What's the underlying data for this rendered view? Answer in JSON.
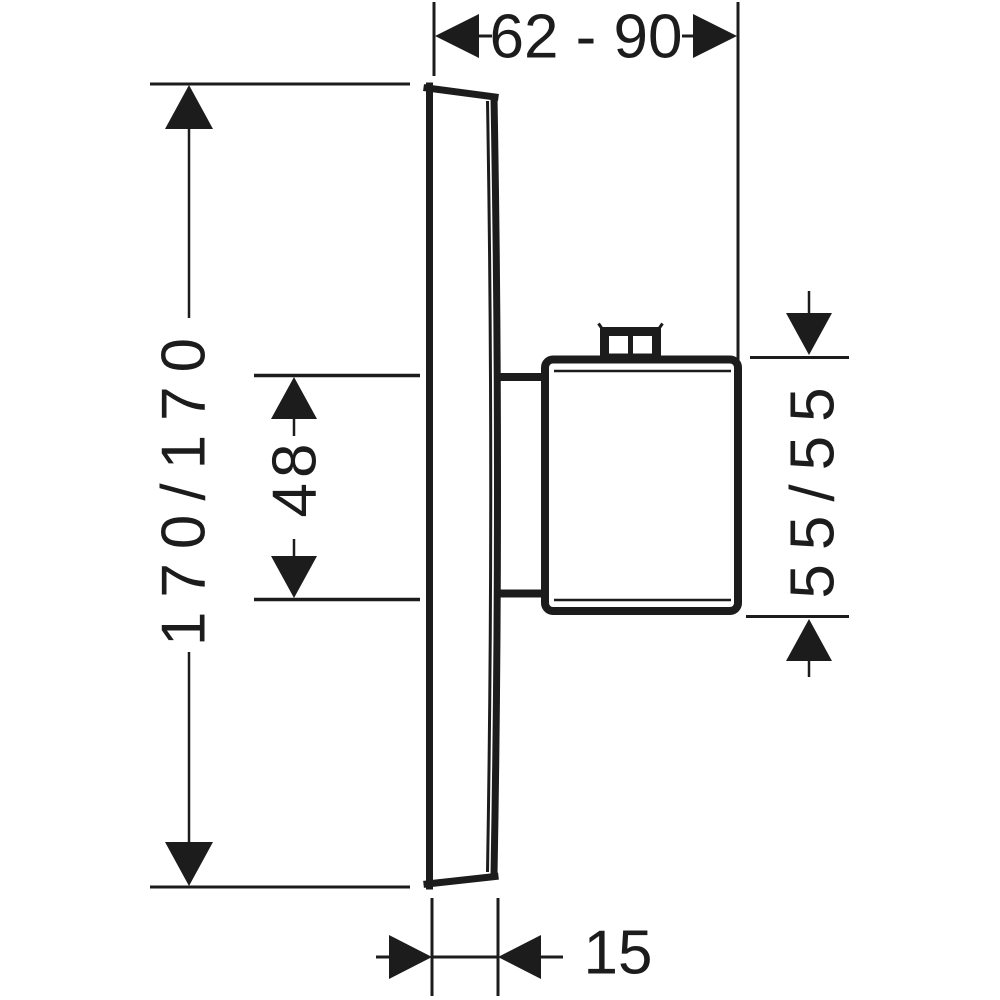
{
  "drawing": {
    "description": "Side-view dimensional drawing of a concealed thermostat mixer (wall plate with handle)"
  },
  "colors": {
    "ink": "#1c1c1c",
    "background": "#ffffff"
  },
  "dimensions": {
    "width_range": {
      "label": "62 - 90",
      "min": 62,
      "max": 90
    },
    "plate_height": {
      "label": "170/170",
      "values": [
        170,
        170
      ]
    },
    "stem_height": {
      "label": "48",
      "values": [
        48
      ]
    },
    "handle_height": {
      "label": "55/55",
      "values": [
        55,
        55
      ]
    },
    "plate_depth": {
      "label": "15",
      "values": [
        15
      ]
    }
  }
}
